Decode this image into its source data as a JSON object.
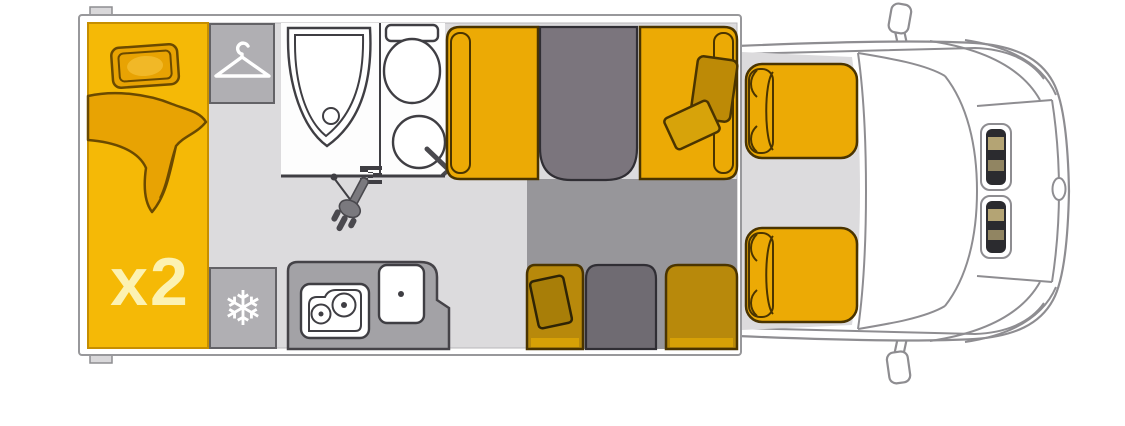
{
  "diagram_title": "motorhome-floorplan-top-view",
  "bed": {
    "capacity_label": "x2"
  },
  "icons": {
    "snowflake": "❄",
    "hanger": "clothes-hanger-icon",
    "shower_head": "hand-shower-icon"
  },
  "components": [
    "rear-bed",
    "wardrobe",
    "shower",
    "toilet",
    "washbasin",
    "fridge",
    "hob",
    "kitchen-sink",
    "dinette-seats",
    "dinette-tables",
    "drop-down-bed-shadow",
    "passenger-seat",
    "driver-seat",
    "vehicle-cab-front"
  ],
  "colors": {
    "floor": "#dcdbdd",
    "shadow": "#97969a",
    "wall-line": "#98989b",
    "body-line": "#8e8d91",
    "cabinet": "#b0afb3",
    "cabinet-line": "#636266",
    "counter": "#a3a2a6",
    "counter-line": "#454348",
    "bed-yellow": "#f5b906",
    "bed-line": "#c68e00",
    "bedding": "#e8a303",
    "bedding-line": "#6b4a00",
    "seat-yellow": "#ecaa05",
    "seat-line": "#4a3400",
    "seat-shadow": "#b8890b",
    "cushion": "#bd8a06",
    "cushion-light": "#d7a30a",
    "cushion-dark": "#a87e08",
    "table": "#7b757d",
    "table-dark": "#6f6b72",
    "table-line": "#302e34",
    "fixture-line": "#3f3e43",
    "metal": "#7a797e",
    "metal-dark": "#4a494e",
    "headlight-dark": "#2b2b2f",
    "headlight-tan": "#b4a474",
    "label": "#fcf2b2",
    "icon-white": "#ffffff"
  }
}
